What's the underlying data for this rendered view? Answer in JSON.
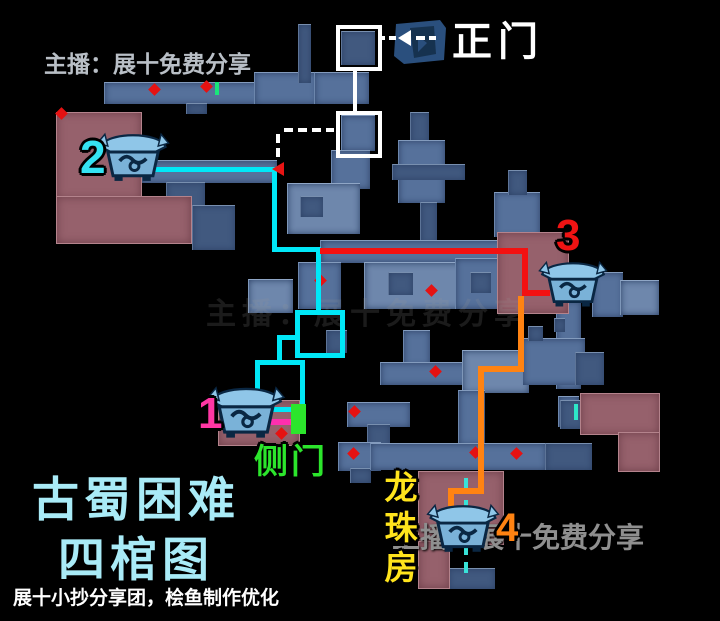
{
  "map_title": {
    "line1": "古蜀困难",
    "line2": "四棺图",
    "color": "#a9ebf7"
  },
  "labels": {
    "main_gate": "正门",
    "side_door": "侧门",
    "dragon_pearl_room": "龙珠房"
  },
  "watermarks": {
    "top_left": "主播：展十免费分享",
    "center_faint": "主播：展十免费分享",
    "bottom_right": "主播：展十免费分享"
  },
  "credit": "展十小抄分享团，桧鱼制作优化",
  "coffins": [
    {
      "number": "1",
      "number_color": "#ff37a4",
      "route_color": "#ff2fae"
    },
    {
      "number": "2",
      "number_color": "#35e2f2",
      "route_color": "#00e8f8"
    },
    {
      "number": "3",
      "number_color": "#f01313",
      "route_color": "#f31111"
    },
    {
      "number": "4",
      "number_color": "#ff8312",
      "route_color": "#ff8312"
    }
  ],
  "colors": {
    "corridor": "#56719b",
    "room_highlight": "#6e87ac",
    "treasure_room_pink": "#96616c",
    "side_door_green": "#2ce52c",
    "dragon_room_yellow": "#ffe41c",
    "marker_red": "#e51212",
    "guide_white": "#ffffff"
  }
}
